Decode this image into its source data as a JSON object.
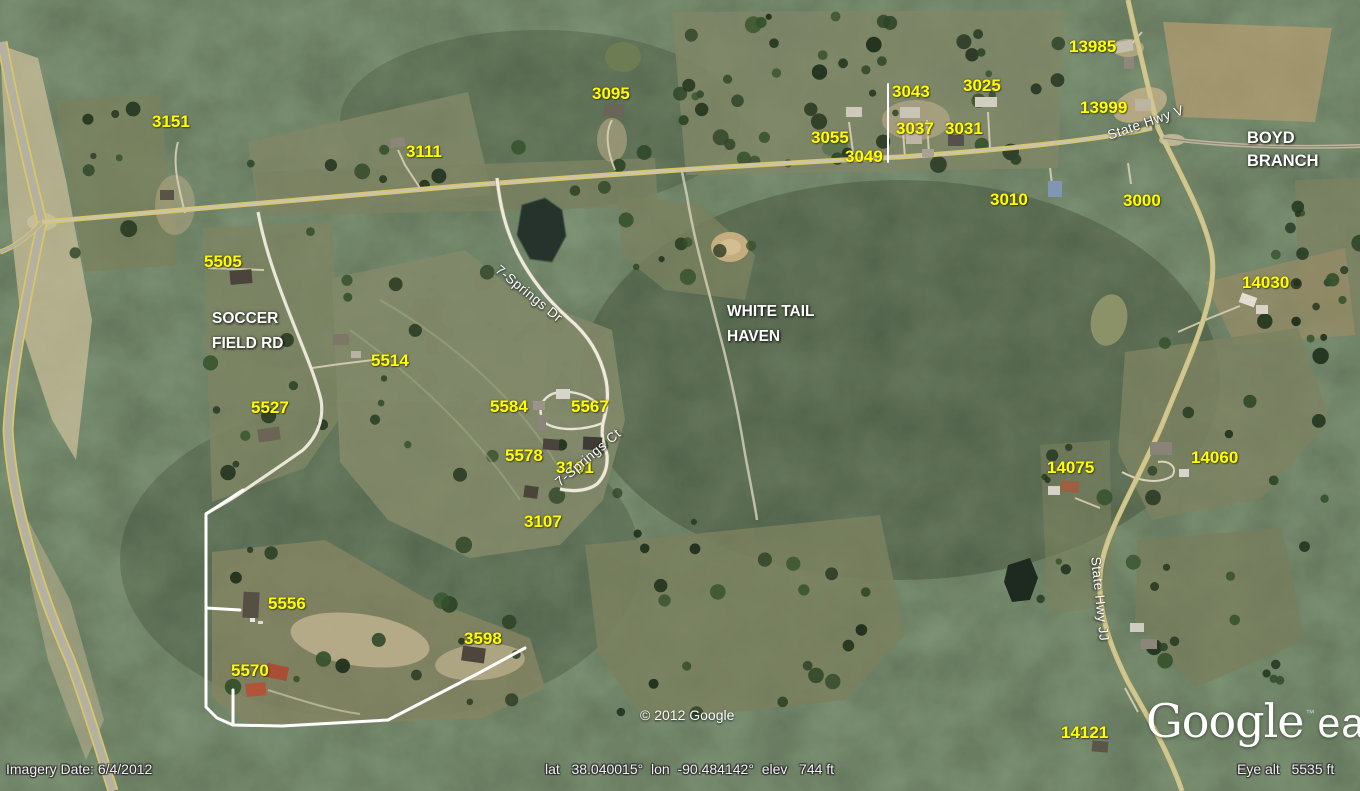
{
  "app": {
    "name": "Google Earth"
  },
  "map": {
    "label_color": "#ffff00",
    "place_label_color": "#ffffff",
    "address_labels": [
      "3151",
      "3111",
      "3095",
      "5505",
      "5514",
      "5527",
      "5584",
      "5567",
      "5578",
      "3101",
      "3107",
      "5556",
      "5570",
      "3598",
      "3055",
      "3049",
      "3043",
      "3037",
      "3031",
      "3025",
      "3010",
      "3000",
      "13985",
      "13999",
      "14030",
      "14075",
      "14060",
      "14121"
    ],
    "places": {
      "soccer_field_rd": {
        "line1": "SOCCER",
        "line2": "FIELD RD"
      },
      "white_tail_haven": {
        "line1": "WHITE TAIL",
        "line2": "HAVEN"
      },
      "boyd_branch": {
        "line1": "BOYD",
        "line2": "BRANCH"
      }
    },
    "road_labels": [
      "State Hwy V",
      "7-Springs Dr",
      "7-Springs Ct",
      "State Hwy JJ"
    ]
  },
  "overlay": {
    "imagery_date": "Imagery Date: 6/4/2012",
    "coordinates": "lat   38.040015°  lon  -90.484142°  elev   744 ft",
    "copyright": "© 2012 Google",
    "eye_altitude": "Eye alt   5535 ft",
    "logo_primary": "Google",
    "logo_tm": "™",
    "logo_secondary": "earth"
  }
}
